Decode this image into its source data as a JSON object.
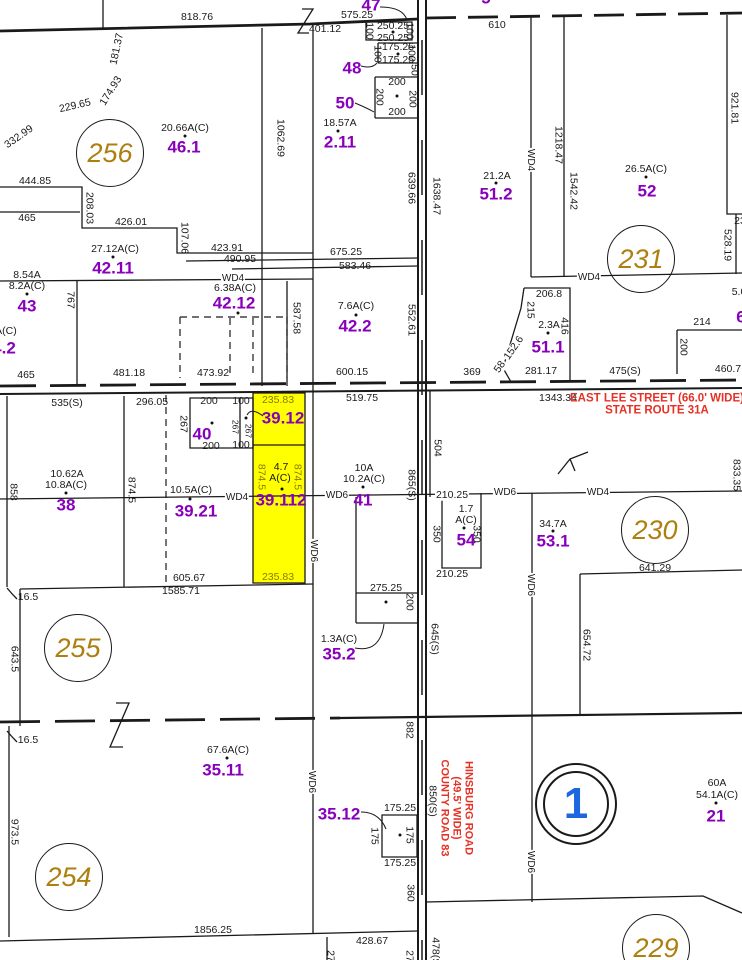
{
  "map": {
    "kind": "cadastral parcel map",
    "width": 742,
    "height": 960,
    "colors": {
      "background": "#ffffff",
      "line": "#1a1a1a",
      "parcel_number": "#8800BB",
      "section_circle": "#AD7F0E",
      "street": "#E53125",
      "highlight": "#FFFF00",
      "highlight_dim": "#8A7A00",
      "special_section": "#1E66E0"
    }
  },
  "highlighted_parcel": {
    "id": "39.112",
    "area": "4.7 A(C)",
    "fill": "#FFFF00",
    "x": 253,
    "y": 393,
    "w": 52,
    "h": 190
  },
  "streets": {
    "east_lee": [
      "EAST LEE STREET (66.0' WIDE)",
      "STATE ROUTE 31A"
    ],
    "hinsburg": [
      "HINSBURG ROAD",
      "(49.5' WIDE)",
      "COUNTY ROAD 83"
    ]
  },
  "sections": [
    {
      "n": "256",
      "x": 110,
      "y": 153
    },
    {
      "n": "231",
      "x": 641,
      "y": 259
    },
    {
      "n": "230",
      "x": 655,
      "y": 530
    },
    {
      "n": "255",
      "x": 78,
      "y": 648
    },
    {
      "n": "254",
      "x": 69,
      "y": 877
    },
    {
      "n": "229",
      "x": 656,
      "y": 948
    },
    {
      "n": "1",
      "x": 576,
      "y": 804,
      "double": true
    }
  ],
  "dots": [
    [
      393,
      32
    ],
    [
      398,
      54
    ],
    [
      397,
      96
    ],
    [
      338,
      131
    ],
    [
      185,
      136
    ],
    [
      496,
      183
    ],
    [
      646,
      177
    ],
    [
      113,
      257
    ],
    [
      27,
      294
    ],
    [
      238,
      313
    ],
    [
      356,
      315
    ],
    [
      548,
      333
    ],
    [
      212,
      423
    ],
    [
      246,
      418
    ],
    [
      66,
      493
    ],
    [
      190,
      499
    ],
    [
      282,
      489
    ],
    [
      363,
      487
    ],
    [
      386,
      602
    ],
    [
      553,
      531
    ],
    [
      464,
      528
    ],
    [
      227,
      758
    ],
    [
      400,
      835
    ],
    [
      716,
      803
    ]
  ],
  "labels": [
    {
      "t": "818.76",
      "x": 197,
      "y": 17
    },
    {
      "t": "575.25",
      "x": 357,
      "y": 15
    },
    {
      "t": "401.12",
      "x": 325,
      "y": 29
    },
    {
      "t": "610",
      "x": 497,
      "y": 25
    },
    {
      "t": "47",
      "x": 371,
      "y": 5,
      "c": "purple"
    },
    {
      "t": "250.25",
      "x": 393,
      "y": 26
    },
    {
      "t": "100",
      "x": 369,
      "y": 31,
      "r": 90
    },
    {
      "t": "100",
      "x": 409,
      "y": 31,
      "r": 90
    },
    {
      "t": "250.25",
      "x": 393,
      "y": 38
    },
    {
      "t": "175.25",
      "x": 398,
      "y": 47
    },
    {
      "t": "100",
      "x": 377,
      "y": 54,
      "r": 90
    },
    {
      "t": "100",
      "x": 411,
      "y": 53,
      "r": 90
    },
    {
      "t": "175.25",
      "x": 398,
      "y": 60
    },
    {
      "t": "48",
      "x": 352,
      "y": 68,
      "c": "purple"
    },
    {
      "t": "50",
      "x": 414,
      "y": 70,
      "r": 90
    },
    {
      "t": "200",
      "x": 397,
      "y": 82
    },
    {
      "t": "200",
      "x": 379,
      "y": 97,
      "r": 90
    },
    {
      "t": "200",
      "x": 412,
      "y": 99,
      "r": 90
    },
    {
      "t": "200",
      "x": 397,
      "y": 112
    },
    {
      "t": "50",
      "x": 345,
      "y": 103,
      "c": "purple"
    },
    {
      "t": "18.57A",
      "x": 340,
      "y": 123
    },
    {
      "t": "2.11",
      "x": 340,
      "y": 142,
      "c": "purple"
    },
    {
      "t": "1062.69",
      "x": 280,
      "y": 138,
      "r": 90
    },
    {
      "t": "20.66A(C)",
      "x": 185,
      "y": 128
    },
    {
      "t": "46.1",
      "x": 184,
      "y": 147,
      "c": "purple"
    },
    {
      "t": "181.37",
      "x": 117,
      "y": 49,
      "r": -78
    },
    {
      "t": "174.93",
      "x": 111,
      "y": 91,
      "r": -58
    },
    {
      "t": "229.65",
      "x": 75,
      "y": 106,
      "r": -13
    },
    {
      "t": "332.99",
      "x": 19,
      "y": 137,
      "r": -35
    },
    {
      "t": "444.85",
      "x": 35,
      "y": 181
    },
    {
      "t": "639.66",
      "x": 411,
      "y": 188,
      "r": 90
    },
    {
      "t": "1638.47",
      "x": 436,
      "y": 196,
      "r": 90
    },
    {
      "t": "921.81",
      "x": 734,
      "y": 108,
      "r": 90
    },
    {
      "t": "1218.47",
      "x": 558,
      "y": 145,
      "r": 90
    },
    {
      "t": "WD4",
      "x": 530,
      "y": 160,
      "r": 90,
      "c": "wd",
      "bg": 1
    },
    {
      "t": "1542.42",
      "x": 573,
      "y": 191,
      "r": 90
    },
    {
      "t": "21.2A",
      "x": 497,
      "y": 176
    },
    {
      "t": "51.2",
      "x": 496,
      "y": 194,
      "c": "purple"
    },
    {
      "t": "26.5A(C)",
      "x": 646,
      "y": 169
    },
    {
      "t": "52",
      "x": 647,
      "y": 191,
      "c": "purple"
    },
    {
      "t": "465",
      "x": 27,
      "y": 218
    },
    {
      "t": "208.03",
      "x": 89,
      "y": 208,
      "r": 90
    },
    {
      "t": "426.01",
      "x": 131,
      "y": 222
    },
    {
      "t": "107.06",
      "x": 184,
      "y": 238,
      "r": 90
    },
    {
      "t": "423.91",
      "x": 227,
      "y": 248
    },
    {
      "t": "490.95",
      "x": 240,
      "y": 259
    },
    {
      "t": "675.25",
      "x": 346,
      "y": 252
    },
    {
      "t": "583.46",
      "x": 355,
      "y": 266
    },
    {
      "t": "27.12A(C)",
      "x": 115,
      "y": 249
    },
    {
      "t": "42.11",
      "x": 113,
      "y": 268,
      "c": "purple"
    },
    {
      "t": "8.54A",
      "x": 27,
      "y": 275
    },
    {
      "t": "8.2A(C)",
      "x": 27,
      "y": 286
    },
    {
      "t": "43",
      "x": 27,
      "y": 306,
      "c": "purple"
    },
    {
      "t": "767",
      "x": 70,
      "y": 300,
      "r": 90
    },
    {
      "t": "WD4",
      "x": 233,
      "y": 279,
      "c": "wd",
      "bg": 1
    },
    {
      "t": "6.38A(C)",
      "x": 235,
      "y": 288
    },
    {
      "t": "42.12",
      "x": 234,
      "y": 303,
      "c": "purple"
    },
    {
      "t": "1A(C)",
      "x": 3,
      "y": 331
    },
    {
      "t": "4.2",
      "x": 4,
      "y": 348,
      "c": "purple"
    },
    {
      "t": "7.6A(C)",
      "x": 356,
      "y": 306
    },
    {
      "t": "42.2",
      "x": 355,
      "y": 326,
      "c": "purple"
    },
    {
      "t": "587.58",
      "x": 296,
      "y": 318,
      "r": 90
    },
    {
      "t": "552.61",
      "x": 411,
      "y": 320,
      "r": 90
    },
    {
      "t": "206.8",
      "x": 549,
      "y": 294
    },
    {
      "t": "WD4",
      "x": 589,
      "y": 278,
      "c": "wd",
      "bg": 1
    },
    {
      "t": "215",
      "x": 530,
      "y": 310,
      "r": 90
    },
    {
      "t": "2.3A",
      "x": 549,
      "y": 325
    },
    {
      "t": "51.1",
      "x": 548,
      "y": 347,
      "c": "purple"
    },
    {
      "t": "416",
      "x": 564,
      "y": 326,
      "r": 90
    },
    {
      "t": "152.6",
      "x": 514,
      "y": 348,
      "r": -55,
      "bg": 1
    },
    {
      "t": "58",
      "x": 500,
      "y": 367,
      "r": -55,
      "bg": 1
    },
    {
      "t": "23",
      "x": 740,
      "y": 221
    },
    {
      "t": "528.19",
      "x": 727,
      "y": 245,
      "r": 90
    },
    {
      "t": "5.0",
      "x": 739,
      "y": 292
    },
    {
      "t": "6",
      "x": 741,
      "y": 317,
      "c": "purple"
    },
    {
      "t": "214",
      "x": 702,
      "y": 322
    },
    {
      "t": "200",
      "x": 683,
      "y": 347,
      "r": 90
    },
    {
      "t": "281.17",
      "x": 541,
      "y": 371
    },
    {
      "t": "369",
      "x": 472,
      "y": 372
    },
    {
      "t": "475(S)",
      "x": 625,
      "y": 371
    },
    {
      "t": "460.7",
      "x": 728,
      "y": 369
    },
    {
      "t": "465",
      "x": 26,
      "y": 375
    },
    {
      "t": "481.18",
      "x": 129,
      "y": 373
    },
    {
      "t": "473.92",
      "x": 213,
      "y": 373
    },
    {
      "t": "600.15",
      "x": 352,
      "y": 372
    },
    {
      "t": "1343.34",
      "x": 558,
      "y": 398
    },
    {
      "t": "EAST LEE STREET (66.0' WIDE)",
      "x": 657,
      "y": 399,
      "c": "red"
    },
    {
      "t": "STATE ROUTE 31A",
      "x": 657,
      "y": 411,
      "c": "red"
    },
    {
      "t": "535(S)",
      "x": 67,
      "y": 403
    },
    {
      "t": "296.05",
      "x": 152,
      "y": 402
    },
    {
      "t": "200",
      "x": 209,
      "y": 401
    },
    {
      "t": "100",
      "x": 241,
      "y": 401
    },
    {
      "t": "267",
      "x": 183,
      "y": 424,
      "r": 90
    },
    {
      "t": "40",
      "x": 202,
      "y": 434,
      "c": "purple"
    },
    {
      "t": "267",
      "x": 235,
      "y": 427,
      "r": 90,
      "s": 8.5
    },
    {
      "t": "267",
      "x": 248,
      "y": 431,
      "r": 90,
      "s": 8.5
    },
    {
      "t": "200",
      "x": 211,
      "y": 446
    },
    {
      "t": "100",
      "x": 241,
      "y": 445
    },
    {
      "t": "235.83",
      "x": 278,
      "y": 400,
      "c": "olive"
    },
    {
      "t": "39.12",
      "x": 283,
      "y": 418,
      "c": "purple"
    },
    {
      "t": "519.75",
      "x": 362,
      "y": 398
    },
    {
      "t": "504",
      "x": 437,
      "y": 448,
      "r": 90
    },
    {
      "t": "10.62A",
      "x": 67,
      "y": 474
    },
    {
      "t": "10.8A(C)",
      "x": 66,
      "y": 485
    },
    {
      "t": "38",
      "x": 66,
      "y": 505,
      "c": "purple"
    },
    {
      "t": "858",
      "x": 13,
      "y": 492,
      "r": 90
    },
    {
      "t": "874.5",
      "x": 131,
      "y": 490,
      "r": 90
    },
    {
      "t": "874.5",
      "x": 261,
      "y": 477,
      "r": 90,
      "c": "olive"
    },
    {
      "t": "874.5",
      "x": 297,
      "y": 477,
      "r": 90,
      "c": "olive"
    },
    {
      "t": "4.7",
      "x": 281,
      "y": 467
    },
    {
      "t": "A(C)",
      "x": 280,
      "y": 478
    },
    {
      "t": "39.112",
      "x": 281,
      "y": 500,
      "c": "purple"
    },
    {
      "t": "10.5A(C)",
      "x": 191,
      "y": 490
    },
    {
      "t": "39.21",
      "x": 196,
      "y": 511,
      "c": "purple"
    },
    {
      "t": "WD4",
      "x": 237,
      "y": 498,
      "c": "wd",
      "bg": 1
    },
    {
      "t": "WD6",
      "x": 337,
      "y": 496,
      "c": "wd",
      "bg": 1
    },
    {
      "t": "10A",
      "x": 364,
      "y": 468
    },
    {
      "t": "10.2A(C)",
      "x": 364,
      "y": 479
    },
    {
      "t": "41",
      "x": 363,
      "y": 500,
      "c": "purple"
    },
    {
      "t": "865(S)",
      "x": 411,
      "y": 485,
      "r": 90
    },
    {
      "t": "210.25",
      "x": 452,
      "y": 495,
      "bg": 1
    },
    {
      "t": "WD6",
      "x": 505,
      "y": 493,
      "c": "wd",
      "bg": 1
    },
    {
      "t": "WD4",
      "x": 598,
      "y": 493,
      "c": "wd",
      "bg": 1
    },
    {
      "t": "1.7",
      "x": 466,
      "y": 509
    },
    {
      "t": "A(C)",
      "x": 466,
      "y": 520
    },
    {
      "t": "54",
      "x": 466,
      "y": 540,
      "c": "purple"
    },
    {
      "t": "350",
      "x": 436,
      "y": 534,
      "r": 90
    },
    {
      "t": "350",
      "x": 476,
      "y": 534,
      "r": 90
    },
    {
      "t": "34.7A",
      "x": 553,
      "y": 524
    },
    {
      "t": "53.1",
      "x": 553,
      "y": 541,
      "c": "purple"
    },
    {
      "t": "641.29",
      "x": 655,
      "y": 568
    },
    {
      "t": "833.35",
      "x": 736,
      "y": 475,
      "r": 90
    },
    {
      "t": "210.25",
      "x": 452,
      "y": 574
    },
    {
      "t": "WD6",
      "x": 313,
      "y": 551,
      "r": 90,
      "c": "wd",
      "bg": 1
    },
    {
      "t": "WD6",
      "x": 530,
      "y": 585,
      "r": 90,
      "c": "wd",
      "bg": 1
    },
    {
      "t": "235.83",
      "x": 278,
      "y": 577,
      "c": "olive"
    },
    {
      "t": "605.67",
      "x": 189,
      "y": 578
    },
    {
      "t": "1585.71",
      "x": 181,
      "y": 591
    },
    {
      "t": "16.5",
      "x": 28,
      "y": 597
    },
    {
      "t": "643.5",
      "x": 14,
      "y": 659,
      "r": 90
    },
    {
      "t": "275.25",
      "x": 386,
      "y": 588
    },
    {
      "t": "200",
      "x": 409,
      "y": 602,
      "r": 90
    },
    {
      "t": "1.3A(C)",
      "x": 339,
      "y": 639
    },
    {
      "t": "35.2",
      "x": 339,
      "y": 654,
      "c": "purple"
    },
    {
      "t": "645(S)",
      "x": 434,
      "y": 639,
      "r": 90
    },
    {
      "t": "654.72",
      "x": 586,
      "y": 645,
      "r": 90
    },
    {
      "t": "16.5",
      "x": 28,
      "y": 740
    },
    {
      "t": "882",
      "x": 409,
      "y": 730,
      "r": 90
    },
    {
      "t": "67.6A(C)",
      "x": 228,
      "y": 750
    },
    {
      "t": "35.11",
      "x": 223,
      "y": 770,
      "c": "purple"
    },
    {
      "t": "WD6",
      "x": 311,
      "y": 782,
      "r": 90,
      "c": "wd",
      "bg": 1
    },
    {
      "t": "HINSBURG ROAD",
      "x": 468,
      "y": 808,
      "r": 90,
      "c": "red",
      "s": 11
    },
    {
      "t": "(49.5' WIDE)",
      "x": 456,
      "y": 808,
      "r": 90,
      "c": "red",
      "s": 11
    },
    {
      "t": "COUNTY ROAD 83",
      "x": 444,
      "y": 808,
      "r": 90,
      "c": "red",
      "s": 11
    },
    {
      "t": "850(S)",
      "x": 432,
      "y": 801,
      "r": 90
    },
    {
      "t": "60A",
      "x": 717,
      "y": 783
    },
    {
      "t": "54.1A(C)",
      "x": 717,
      "y": 795
    },
    {
      "t": "21",
      "x": 716,
      "y": 816,
      "c": "purple"
    },
    {
      "t": "35.12",
      "x": 339,
      "y": 814,
      "c": "purple"
    },
    {
      "t": "175.25",
      "x": 400,
      "y": 808
    },
    {
      "t": "175",
      "x": 374,
      "y": 836,
      "r": 90
    },
    {
      "t": "175",
      "x": 409,
      "y": 835,
      "r": 90
    },
    {
      "t": "175.25",
      "x": 400,
      "y": 863
    },
    {
      "t": "973.5",
      "x": 14,
      "y": 832,
      "r": 90
    },
    {
      "t": "WD6",
      "x": 530,
      "y": 862,
      "r": 90,
      "c": "wd",
      "bg": 1
    },
    {
      "t": "360",
      "x": 410,
      "y": 893,
      "r": 90
    },
    {
      "t": "1856.25",
      "x": 213,
      "y": 930
    },
    {
      "t": "428.67",
      "x": 372,
      "y": 941
    },
    {
      "t": "27",
      "x": 330,
      "y": 956,
      "r": 90
    },
    {
      "t": "27",
      "x": 409,
      "y": 956,
      "r": 90
    },
    {
      "t": "478(S)",
      "x": 435,
      "y": 953,
      "r": 90
    },
    {
      "t": "5",
      "x": 486,
      "y": -2,
      "c": "purple"
    }
  ]
}
